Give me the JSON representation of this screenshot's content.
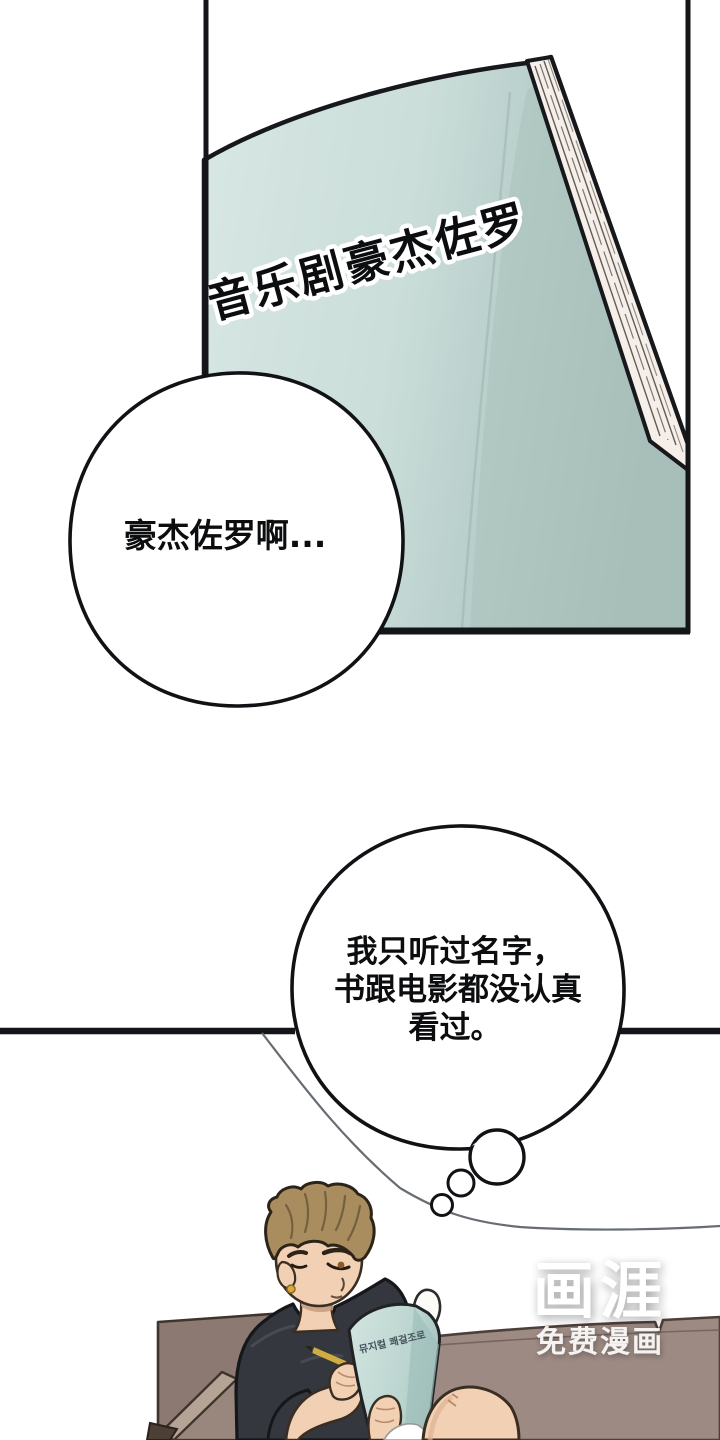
{
  "cover_panel": {
    "title": "音乐剧豪杰佐罗"
  },
  "speech_bubble": {
    "text": "豪杰佐罗啊..."
  },
  "thought_bubble": {
    "line1": "我只听过名字，",
    "line2": "书跟电影都没认真",
    "line3": "看过。"
  },
  "script_book": {
    "title": "뮤지컬 쾌걸조로"
  },
  "watermark": {
    "logo": "画涯",
    "tagline": "免费漫画"
  },
  "colors": {
    "ink": "#17181b",
    "book_cover_teal": "#d6e5e1",
    "book_cover_shadow": "#a9bfba",
    "pages_edge": "#f6efe9",
    "sofa_left": "#8c7a72",
    "sofa_left_armrest": "#b5a496",
    "sofa_wood": "#4c3f34",
    "sofa_right": "#9c8a83",
    "skin": "#f2d0b4",
    "shirt": "#34373d",
    "hair": "#a98d5e",
    "pencil": "#e8c34f",
    "earring": "#d9a93c"
  }
}
